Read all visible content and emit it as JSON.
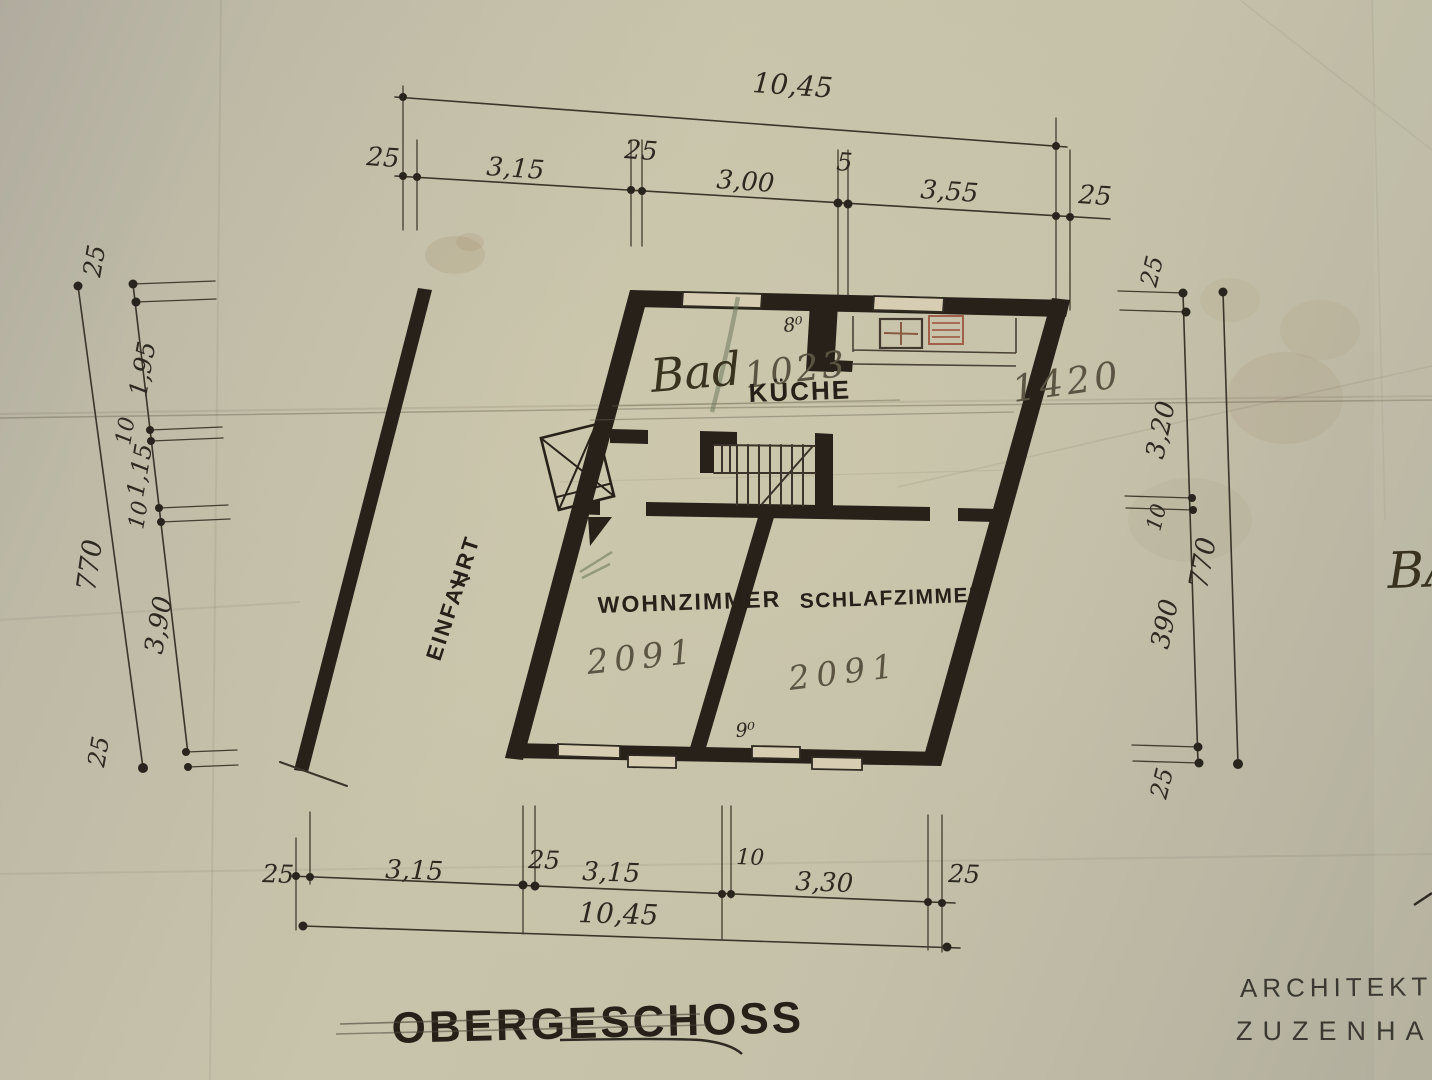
{
  "title": {
    "text": "OBERGESCHOSS"
  },
  "stamp": {
    "line1": "ARCHITEKTUR",
    "line2": "ZUZENHAU"
  },
  "edge_text": "BA",
  "rooms": {
    "bad": {
      "label": "Bad",
      "pencil_number": "1023"
    },
    "kueche": {
      "label": "KÜCHE",
      "pencil_number": "1420"
    },
    "wohnzimmer": {
      "label": "WOHNZIMMER",
      "pencil_number": "2091"
    },
    "schlafzimmer": {
      "label": "SCHLAFZIMMER",
      "pencil_number": "2091"
    },
    "einfahrt": {
      "label": "EINFAHRT"
    }
  },
  "door_widths": {
    "bad_door": "8⁰",
    "room_door": "9⁰"
  },
  "dims": {
    "top": {
      "overall": "10,45",
      "s": [
        "25",
        "3,15",
        "25",
        "3,00",
        "5",
        "3,55",
        "25"
      ]
    },
    "bottom": {
      "overall": "10,45",
      "s": [
        "25",
        "3,15",
        "25",
        "3,15",
        "10",
        "3,30",
        "25"
      ]
    },
    "left": {
      "overall": "770",
      "s": [
        "25",
        "1,95",
        "10",
        "1,15",
        "10",
        "3,90",
        "25"
      ]
    },
    "right": {
      "overall": "770",
      "s": [
        "25",
        "3,20",
        "10",
        "390",
        "25"
      ]
    }
  },
  "colors": {
    "paper": "#c6c2ab",
    "ink": "#27211a",
    "pencil": "#5b5443",
    "red_pencil": "#a2604a",
    "green_pencil": "#6f7a5e"
  }
}
